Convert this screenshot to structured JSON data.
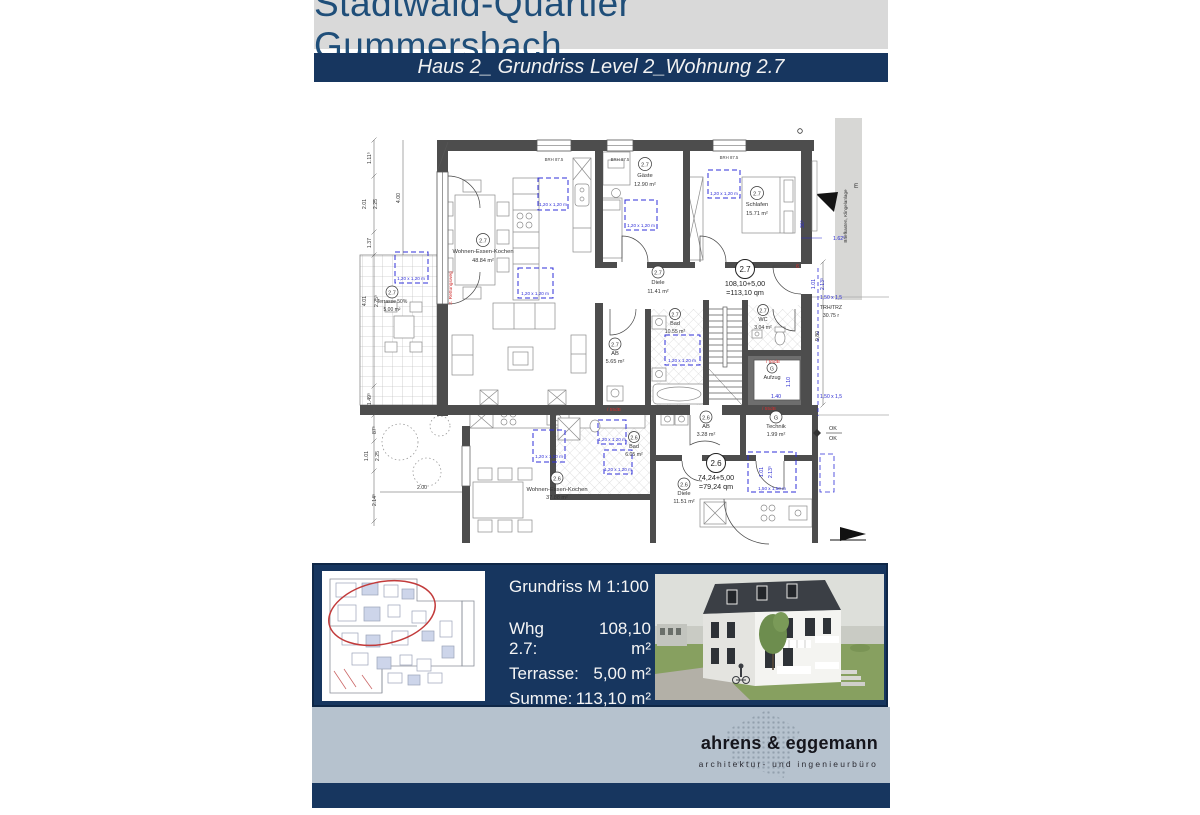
{
  "header": {
    "title": "Stadtwald-Quartier Gummersbach",
    "subtitle": "Haus 2_ Grundriss Level 2_Wohnung 2.7"
  },
  "plan": {
    "rooms": [
      {
        "unit": "2.7",
        "name": "Wohnen-Essen-Kochen",
        "area": "48.84 m²"
      },
      {
        "unit": "2.7",
        "name": "Gäste",
        "area": "12.90 m²"
      },
      {
        "unit": "2.7",
        "name": "Schlafen",
        "area": "15.71 m²"
      },
      {
        "unit": "2.7",
        "name": "Diele",
        "area": "11.41 m²"
      },
      {
        "unit": "2.7",
        "name": "Bad",
        "area": "10.55 m²"
      },
      {
        "unit": "2.7",
        "name": "WC",
        "area": "3.04 m²"
      },
      {
        "unit": "2.7",
        "name": "AB",
        "area": "5.65 m²"
      },
      {
        "unit": "2.7",
        "name": "Terrasse 50%",
        "area": "5,00 m²"
      },
      {
        "unit": "2.6",
        "name": "AB",
        "area": "3.28 m²"
      },
      {
        "unit": "G",
        "name": "Technik",
        "area": "1.99 m²"
      },
      {
        "unit": "2.6",
        "name": "Diele",
        "area": "11.51 m²"
      },
      {
        "unit": "2.6",
        "name": "Bad",
        "area": "6.05 m²"
      },
      {
        "unit": "2.6",
        "name": "Wohnen-Essen-Kochen",
        "area": "37.88 m²"
      },
      {
        "unit": "G",
        "name": "Aufzug",
        "area": ""
      }
    ],
    "totals": [
      {
        "unit": "2.7",
        "sum": "108,10+5,00",
        "result": "=113,10 qm"
      },
      {
        "unit": "2.6",
        "sum": "74,24+5,00",
        "result": "=79,24 qm"
      }
    ],
    "window_label": "BRH 87.5",
    "grid_120": "1,20 x 1,20 m",
    "grid_150": "1,50 x 1,50 m",
    "grid_150_short": "1,50 x 1,5",
    "dims_left": {
      "d1": "1.11⁵",
      "d2": "2.01",
      "d3": "2.25",
      "d4": "1.37",
      "d5": "4.00",
      "d6": "4.01",
      "d7": "2.25⁵",
      "d8": "1.49⁵",
      "d9": "87⁵",
      "d10": "1.01",
      "d11": "2.25",
      "d12": "2.14⁵",
      "d13": "2.00"
    },
    "dims_right": {
      "d1": "1.62⁵",
      "d2": "36⁵",
      "d3": "1.01",
      "d4": "2.13⁵",
      "d5": "TRH/TRZ",
      "d6": "30.75 r",
      "d7": "9,80"
    },
    "lift_dims": {
      "w": "1.40",
      "d": "1.10"
    },
    "red_notes": {
      "rescue": "2. Rettungsweg",
      "sound": "/ 55dB",
      "six": "6"
    },
    "side_notes": {
      "mailbox": "Briefkasten, Klingelanlage",
      "e": "E",
      "ok_top": "OK",
      "ok_bottom": "OK"
    }
  },
  "footer": {
    "scale_label": "Grundriss M 1:100",
    "rows": [
      {
        "label": "Whg 2.7:",
        "value": "108,10 m²"
      },
      {
        "label": "Terrasse:",
        "value": "5,00 m²"
      },
      {
        "label": "Summe:",
        "value": "113,10 m²"
      }
    ]
  },
  "logo": {
    "name": "ahrens & eggemann",
    "tagline": "architektur- und ingenieurbüro"
  },
  "colors": {
    "navy": "#17365f",
    "title_blue": "#1f4e79",
    "band": "#b6c2ce",
    "accent_red": "#c23b3b",
    "dim_blue": "#2a2ad0",
    "wall_gray": "#4d4d4d"
  }
}
